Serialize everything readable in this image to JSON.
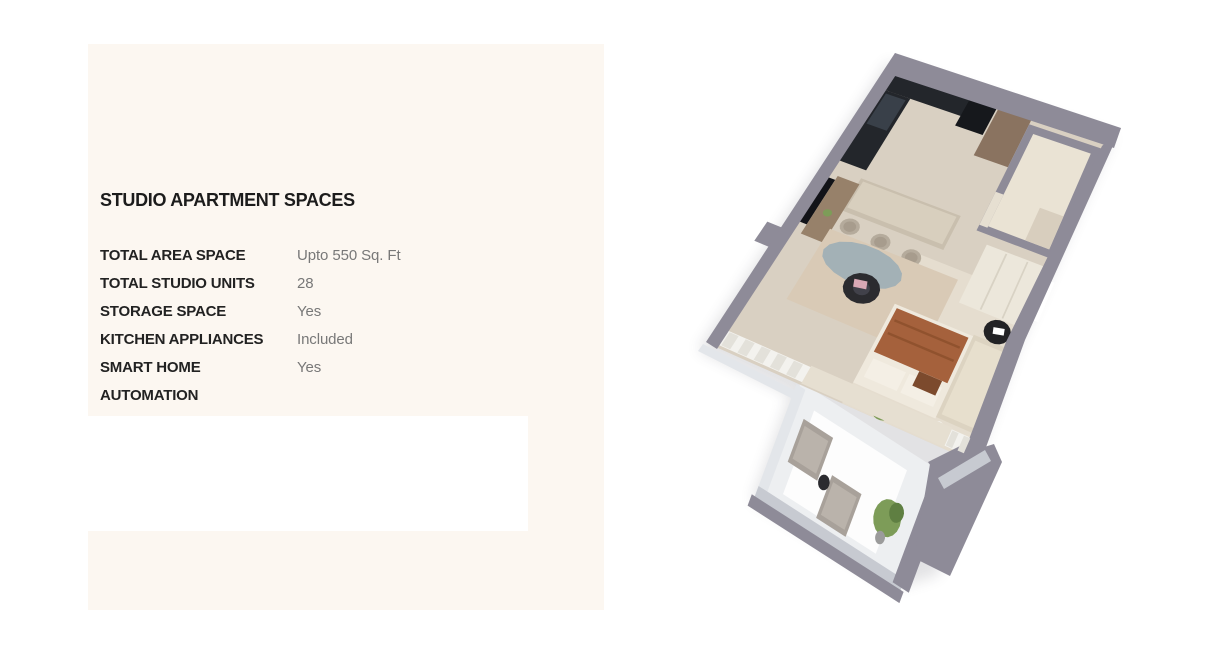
{
  "page": {
    "background": "#ffffff"
  },
  "panel": {
    "background": "#fcf7f1",
    "title": "STUDIO APARTMENT SPACES",
    "specs": [
      {
        "label": "TOTAL AREA SPACE",
        "value": "Upto 550 Sq. Ft"
      },
      {
        "label": "TOTAL STUDIO UNITS",
        "value": "28"
      },
      {
        "label": "STORAGE SPACE",
        "value": "Yes"
      },
      {
        "label": "KITCHEN APPLIANCES",
        "value": "Included"
      },
      {
        "label": "SMART HOME AUTOMATION",
        "value": "Yes"
      }
    ]
  },
  "floorplan": {
    "alt": "3D isometric render of a studio apartment: kitchen with island, bathroom, wardrobe, living and sleeping area, balcony with seating",
    "palette": {
      "wall": "#8e8b98",
      "glass": "#e3e6ea",
      "railing": "#c7cad1",
      "shadow": "#52525e",
      "floor": "#d9d0c2",
      "floor_light": "#e6dfd1",
      "counter_dark": "#23262b",
      "fridge": "#16181c",
      "hob": "#394049",
      "wood": "#8a7360",
      "island": "#c9bfae",
      "island_top": "#d8cfbe",
      "stool": "#b5ab9c",
      "stool_dark": "#a79c8d",
      "bath_inner": "#eae3d4",
      "bath_vanity": "#d8cebe",
      "wardrobe": "#ece7db",
      "seam": "#d8d2c4",
      "tv": "#121318",
      "console_wood": "#97816a",
      "pouf": "#b1a494",
      "rug": "#d9cab6",
      "rug_oval": "#a3b1b6",
      "table_dark": "#2b2b2f",
      "tray": "#41414a",
      "book_pink": "#d9a8b5",
      "bed": "#efe9dd",
      "blanket": "#a5613c",
      "blanket_fold": "#7c431f",
      "pillow": "#f4efe5",
      "brown_pillow": "#7c4a2d",
      "sofa": "#dcd3c1",
      "sofa_light": "#e7dfcd",
      "chair_black": "#222225",
      "greens": "#7d9c58",
      "greens_dark": "#5f7f42",
      "pot_gray": "#9b9b9b",
      "lamp": "#f6f4ee",
      "balcony_floor": "#edeff1",
      "lounger": "#a8a19a",
      "lounger_light": "#bab3ab",
      "curtain": "#f3f2ee",
      "curtain_stripe": "#e3e1da",
      "white": "#ffffff"
    }
  }
}
